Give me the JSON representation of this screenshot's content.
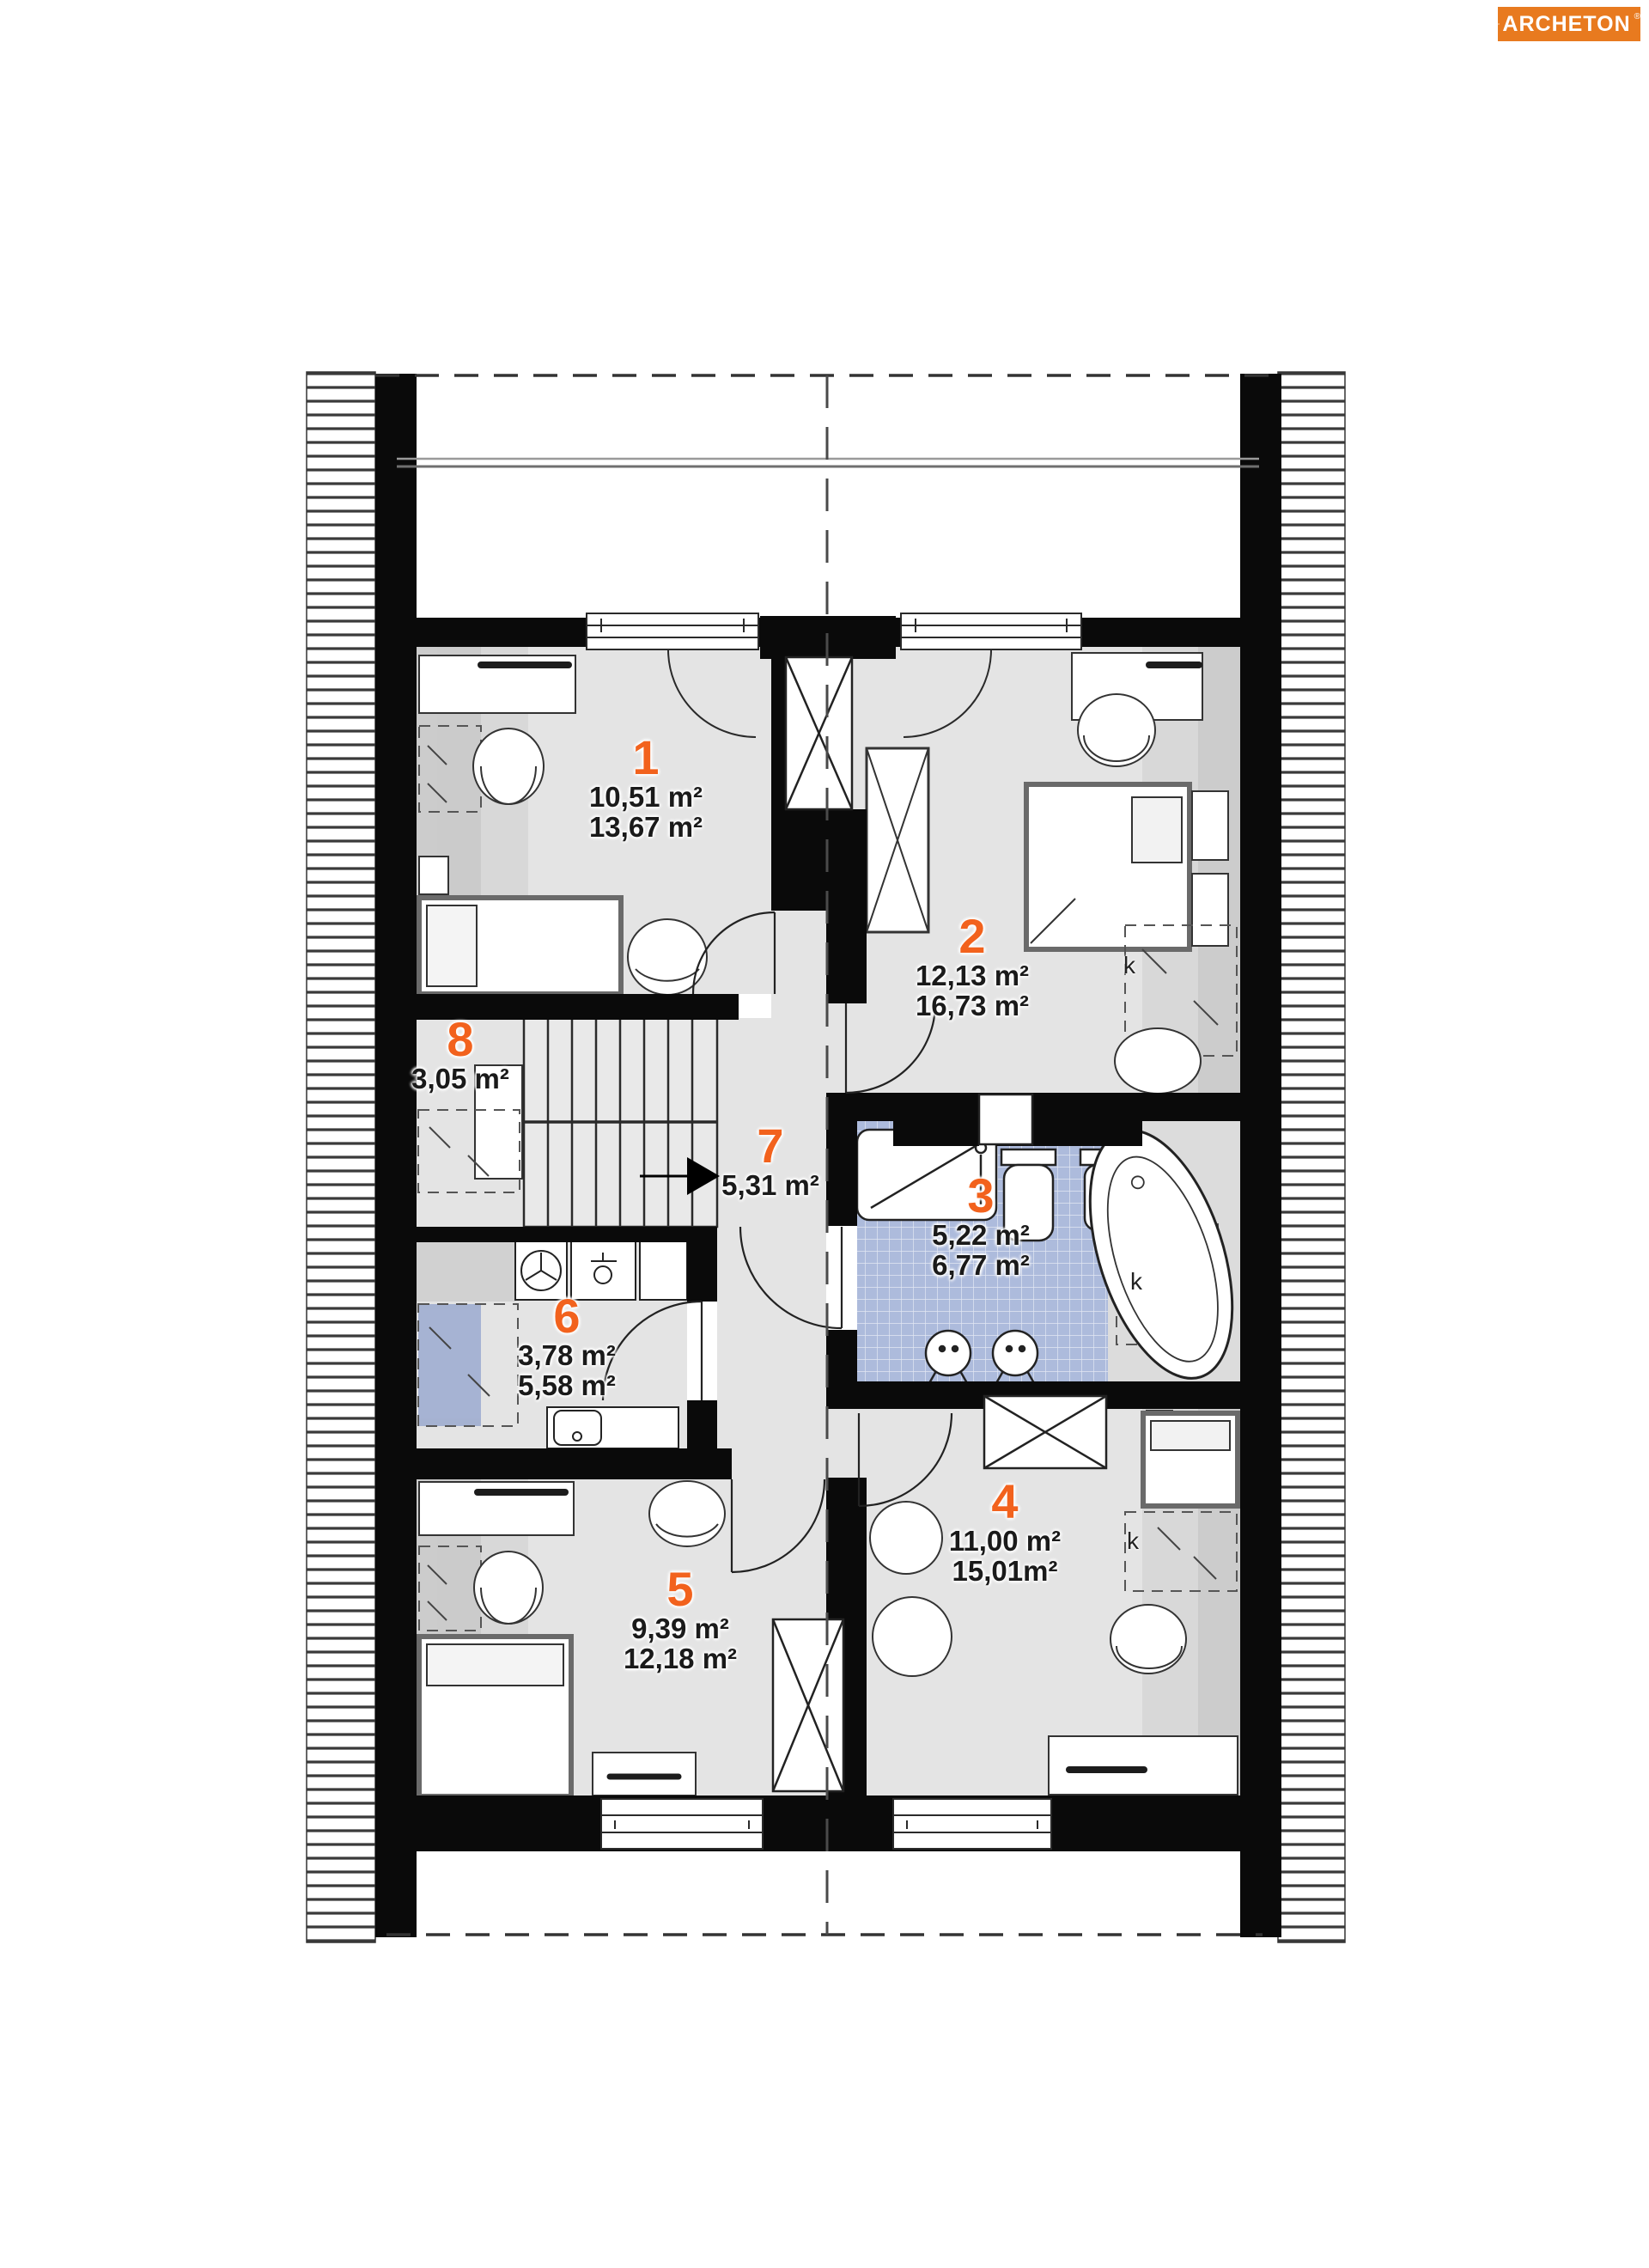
{
  "logo": {
    "name": "ARCHETON",
    "reg": "®"
  },
  "plan": {
    "rooms": [
      {
        "id": "1",
        "line1": "10,51 m²",
        "line2": "13,67 m²"
      },
      {
        "id": "2",
        "line1": "12,13 m²",
        "line2": "16,73 m²"
      },
      {
        "id": "3",
        "line1": "5,22 m²",
        "line2": "6,77 m²"
      },
      {
        "id": "4",
        "line1": "11,00 m²",
        "line2": "15,01m²"
      },
      {
        "id": "5",
        "line1": "9,39 m²",
        "line2": "12,18 m²"
      },
      {
        "id": "6",
        "line1": "3,78 m²",
        "line2": "5,58 m²"
      },
      {
        "id": "7",
        "line1": "5,31 m²",
        "line2": ""
      },
      {
        "id": "8",
        "line1": "3,05 m²",
        "line2": ""
      }
    ],
    "closet_labels": [
      "k",
      "k",
      "k"
    ],
    "colors": {
      "accent_orange": "#f2621d",
      "logo_background": "#e87a1f",
      "wall_black": "#0a0a0a",
      "floor_gray": "#e4e4e4",
      "knee_zone_gray": "#cdcdcd",
      "tile_blue": "#adbbdc",
      "text_dark": "#1a1a1a"
    }
  }
}
